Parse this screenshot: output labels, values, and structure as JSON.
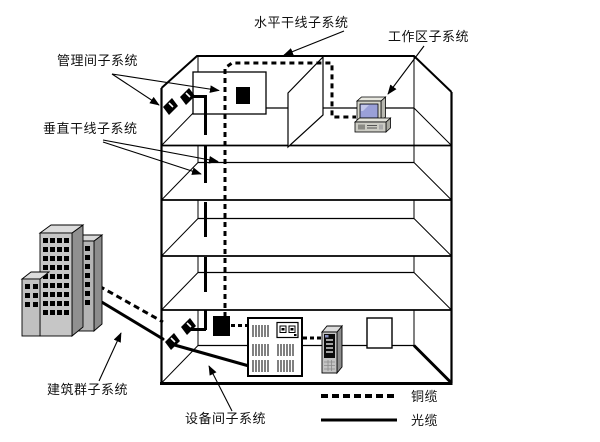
{
  "diagram": {
    "callouts": {
      "horizontal_backbone": "水平干线子系统",
      "work_area": "工作区子系统",
      "management_room": "管理间子系统",
      "vertical_backbone": "垂直干线子系统",
      "building_group": "建筑群子系统",
      "equipment_room": "设备间子系统"
    },
    "legend": {
      "items": [
        {
          "label": "铜缆",
          "style": "dashed"
        },
        {
          "label": "光缆",
          "style": "solid"
        }
      ]
    },
    "icons": [
      "campus-buildings-icon",
      "wall-connector-icon",
      "distribution-box-icon",
      "pc-workstation-icon",
      "equipment-rack-icon",
      "server-tower-icon"
    ],
    "colors": {
      "line": "#000000",
      "background": "#ffffff",
      "building_front": "#c6c6c6",
      "building_side": "#909090",
      "building_top": "#dcdcdc",
      "screen_blue": "#9aa0d8"
    }
  }
}
